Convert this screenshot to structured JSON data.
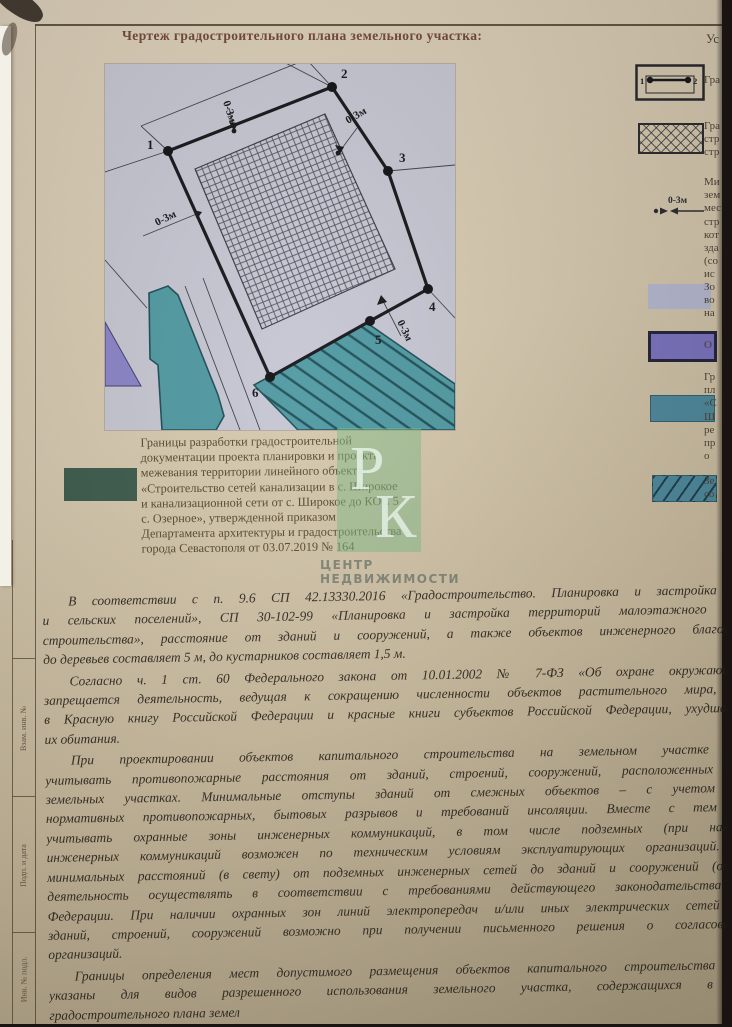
{
  "title": "Чертеж градостроительного плана земельного участка:",
  "colors": {
    "plan_bg": "#c6c7d3",
    "teal": "#4f99a2",
    "teal_dark": "#1d4e57",
    "purple_shape": "#8a84c8",
    "legend_purple": "#7b74c3",
    "legend_lavender": "#b8bcd5",
    "legend_teal": "#4e8ba0",
    "green_swatch": "#3c5b4c",
    "watermark_green": "rgba(126,187,136,0.6)",
    "boundary": "#15151a"
  },
  "diagram": {
    "points": [
      "1",
      "2",
      "3",
      "4",
      "5",
      "6"
    ],
    "dim_label": "0-3м"
  },
  "caption": {
    "lines": [
      "Границы разработки градостроительной",
      "документации проекта планировки и проекта",
      "межевания территории линейного объекта",
      "«Строительство сетей канализации в с. Широкое",
      "и канализационной сети от с. Широкое до КОС 5",
      "с. Озерное», утвержденной приказом",
      "Департамента архитектуры и градостроительства",
      "города Севастополя от 03.07.2019 № 164"
    ]
  },
  "watermark": {
    "letter1": "Р",
    "letter2": "К",
    "brand_line1": "ЦЕНТР",
    "brand_line2": "НЕДВИЖИМОСТИ"
  },
  "legend": {
    "heading_fragment": "Ус",
    "items": [
      {
        "symbol": "boundary",
        "points": [
          "1",
          "2"
        ],
        "label_lines": [
          "Гра"
        ]
      },
      {
        "symbol": "crosshatch",
        "label_lines": [
          "Гра",
          "стр",
          "стр"
        ]
      },
      {
        "symbol": "offset",
        "symbol_label": "0-3м",
        "label_lines": [
          "Ми",
          "зем",
          "мес",
          "стр",
          "кот",
          "зда",
          "(со",
          "ис"
        ]
      },
      {
        "symbol": "swatch",
        "color": "#b8bcd5",
        "border": "none",
        "label_lines": [
          "Зо",
          "во",
          "на"
        ]
      },
      {
        "symbol": "swatch",
        "color": "#7b74c3",
        "border": "3px solid #23233a",
        "label_lines": [
          "О"
        ]
      },
      {
        "symbol": "swatch",
        "color": "#4e8ba0",
        "border": "1px solid rgba(30,70,80,.6)",
        "label_lines": [
          "Гр",
          "пл",
          "«С",
          "Ш",
          "ре",
          "пр",
          "о"
        ]
      },
      {
        "symbol": "swatch-hatched",
        "color": "#4e8ba0",
        "border": "1px solid rgba(30,70,80,.6)",
        "label_lines": [
          "Зе",
          "со"
        ]
      }
    ]
  },
  "stamp_labels": [
    "Взам. инв. №",
    "Подп. и дата",
    "Инв. № подл."
  ],
  "paragraphs": [
    {
      "lines": [
        "В соответствии с  п. 9.6 СП 42.13330.2016 «Градостроительство. Планировка и застройка го",
        "и сельских поселений», СП 30-102-99 «Планировка и застройка территорий малоэтажного жи",
        "строительства», расстояние от зданий и сооружений, а также объектов инженерного благоуст",
        "до деревьев составляет 5 м, до кустарников составляет 1,5 м."
      ]
    },
    {
      "lines": [
        "Согласно ч. 1 ст. 60 Федерального закона от 10.01.2002 № 7-ФЗ «Об охране окружающей",
        "запрещается деятельность, ведущая к сокращению численности объектов растительного мира, за",
        "в Красную книгу Российской Федерации и красные книги субъектов Российской Федерации, ухудшающ",
        "их обитания."
      ]
    },
    {
      "lines": [
        "При проектировании объектов капитального строительства на земельном участке не",
        "учитывать противопожарные расстояния от зданий, строений, сооружений, расположенных на",
        "земельных участках. Минимальные отступы зданий от смежных объектов – с учетом со",
        "нормативных противопожарных, бытовых разрывов и требований инсоляции. Вместе с тем не",
        "учитывать охранные зоны инженерных коммуникаций, в том числе подземных (при наличи",
        "инженерных коммуникаций возможен по техническим условиям эксплуатирующих организаций. В",
        "минимальных расстояний (в свету) от подземных инженерных сетей до зданий и сооружений (охран",
        "деятельность осуществлять в соответствии с требованиями действующего законодательства Р",
        "Федерации. При наличии охранных зон линий электропередач и/или иных электрических сетей ра",
        "зданий, строений, сооружений возможно при получении письменного решения о согласовании",
        "организаций."
      ]
    },
    {
      "lines": [
        "Границы определения мест допустимого размещения объектов капитального строительства (да",
        "указаны для видов разрешенного использования земельного участка, содержащихся в пу",
        "градостроительного плана земел"
      ]
    }
  ]
}
